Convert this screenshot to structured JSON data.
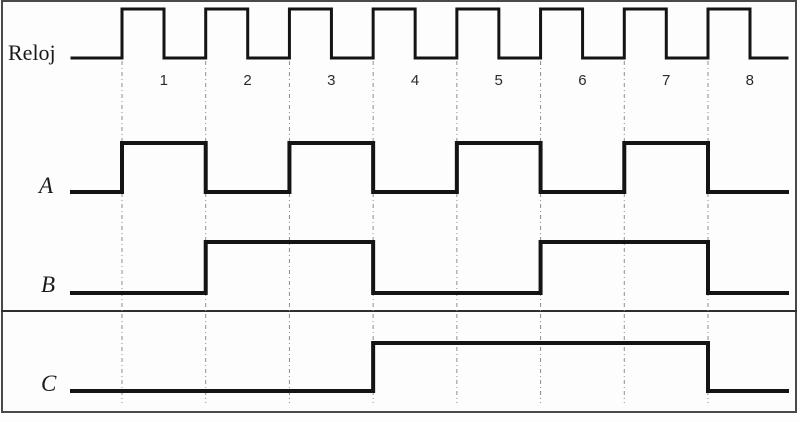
{
  "figure": {
    "type": "timing-diagram",
    "clock": {
      "label": "Reloj",
      "cycle_numbers": [
        "1",
        "2",
        "3",
        "4",
        "5",
        "6",
        "7",
        "8"
      ],
      "initial_level": 0,
      "final_level": 0,
      "pulses": 8,
      "duty_cycle": 0.5
    },
    "signals": [
      {
        "label": "A",
        "initial_level": 0,
        "levels_per_cycle": [
          1,
          0,
          1,
          0,
          1,
          0,
          1,
          0
        ],
        "final_level": 0
      },
      {
        "label": "B",
        "initial_level": 0,
        "levels_per_cycle": [
          0,
          1,
          1,
          0,
          0,
          1,
          1,
          0
        ],
        "final_level": 0
      },
      {
        "label": "C",
        "initial_level": 0,
        "levels_per_cycle": [
          0,
          0,
          0,
          1,
          1,
          1,
          1,
          0
        ],
        "final_level": 0
      }
    ],
    "colors": {
      "line": "#141414",
      "guide": "#8f8f8f",
      "frame": "#4a4a4a",
      "text": "#1a1a1a",
      "number": "#2b2b2b",
      "background": "#fdfdfd"
    }
  }
}
